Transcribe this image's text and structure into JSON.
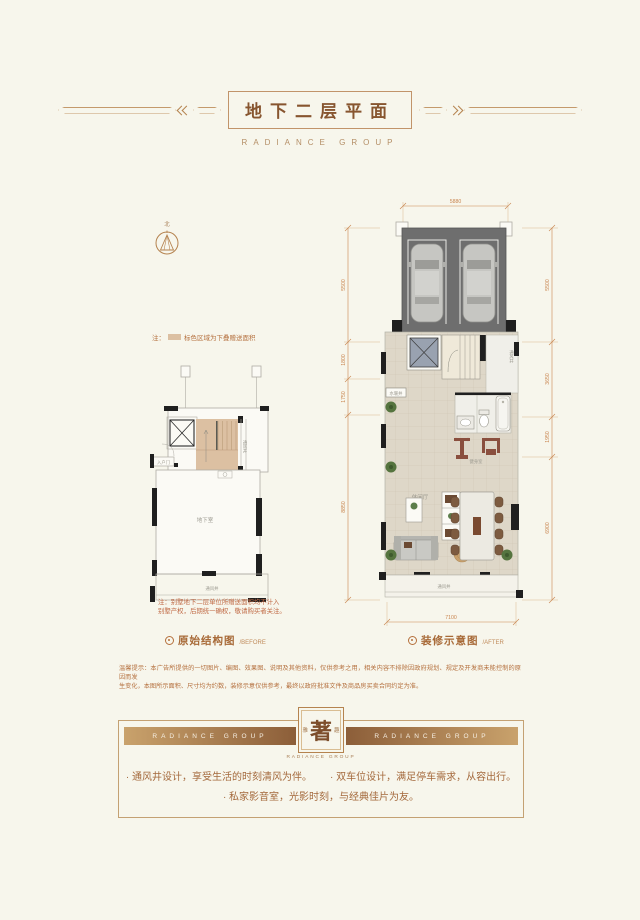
{
  "accents": {
    "background": "#f7f6ec",
    "line_gold": "#c49a6c",
    "title_brown": "#87552f",
    "dim_orange": "#c9854f",
    "note_red": "#c06a45",
    "bonus_area_tan": "#dcc0a2",
    "footer_bar_dark": "#8c5e39",
    "footer_bar_light": "#c9a26c"
  },
  "header": {
    "title": "地下二层平面",
    "brand": "RADIANCE GROUP"
  },
  "compass": {
    "north_label": "北"
  },
  "legend_note": {
    "prefix": "注：",
    "text": "标色区域为下叠赠送面积"
  },
  "left_plan": {
    "caption": "原始结构图",
    "caption_en": "/BEFORE",
    "entry_label": "入户门",
    "well_label": "通风井",
    "room_label": "地下室",
    "vent_bottom_label": "通风井",
    "note1": "注：别墅地下二层单位所赠送面积均不计入",
    "note2": "别墅产权，后期统一确权，敬请购买者关注。"
  },
  "right_plan": {
    "caption": "装修示意图",
    "caption_en": "/AFTER",
    "gym_label": "健身室",
    "lounge_label": "休闲厅",
    "pipe_label": "水暖井",
    "vent_side_label": "通风井",
    "vent_bottom_label": "通风井",
    "dim_top": "5880",
    "dim_bottom": "7100",
    "dims_right": [
      "5500",
      "3650",
      "1950",
      "6900"
    ],
    "dims_left": [
      "5500",
      "1800",
      "1750",
      "8850"
    ]
  },
  "disclaimer": {
    "line1": "温馨提示：本广告所提供的一切图片、编图、效果图、说明及其他资料，仅供参考之用，相关内容不排除因政府规划、规定及开发商未能控制的原因而发",
    "line2": "生变化，本图所示面积、尺寸均为约数，装修示意仅供参考，最终以政府批准文件及商品房买卖合同约定为准。"
  },
  "footer": {
    "bar_left": "RADIANCE GROUP",
    "bar_right": "RADIANCE GROUP",
    "seal_left": "雅",
    "seal_main": "著",
    "seal_right": "趣",
    "seal_sub": "RADIANCE GROUP",
    "bullets": [
      "· 通风井设计，享受生活的时刻清风为伴。",
      "· 双车位设计，满足停车需求，从容出行。",
      "· 私家影音室，光影时刻，与经典佳片为友。"
    ]
  }
}
